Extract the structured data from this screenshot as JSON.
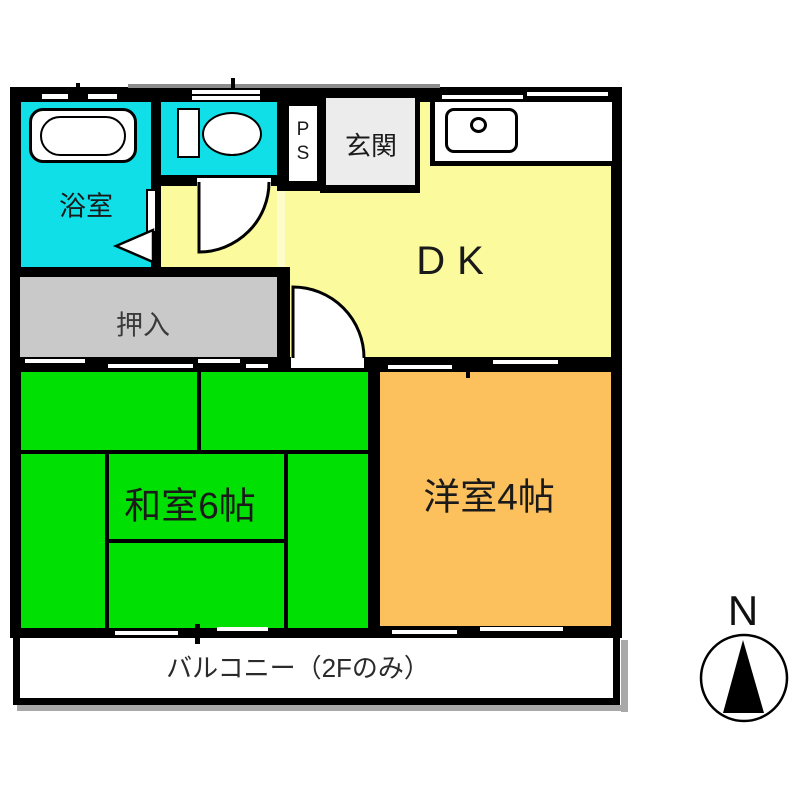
{
  "plan": {
    "rooms": {
      "bathroom": {
        "label": "浴室",
        "color": "#10dfe8"
      },
      "toilet": {
        "color": "#10dfe8"
      },
      "pipe_space": {
        "label": "PS"
      },
      "entrance": {
        "label": "玄関",
        "color": "#ececec"
      },
      "dining_kitchen": {
        "label": "DK",
        "color": "#fbfb9e"
      },
      "closet": {
        "label": "押入",
        "color": "#c9c9c9"
      },
      "japanese_room": {
        "label": "和室6帖",
        "color": "#00e103"
      },
      "western_room": {
        "label": "洋室4帖",
        "color": "#fcc05c"
      },
      "balcony": {
        "label": "バルコニー（2Fのみ）",
        "color": "#ffffff"
      }
    },
    "compass": {
      "label": "N"
    },
    "colors": {
      "wall": "#000000",
      "shadow": "#a8a8a8",
      "fixture_fill": "#ffffff"
    }
  }
}
